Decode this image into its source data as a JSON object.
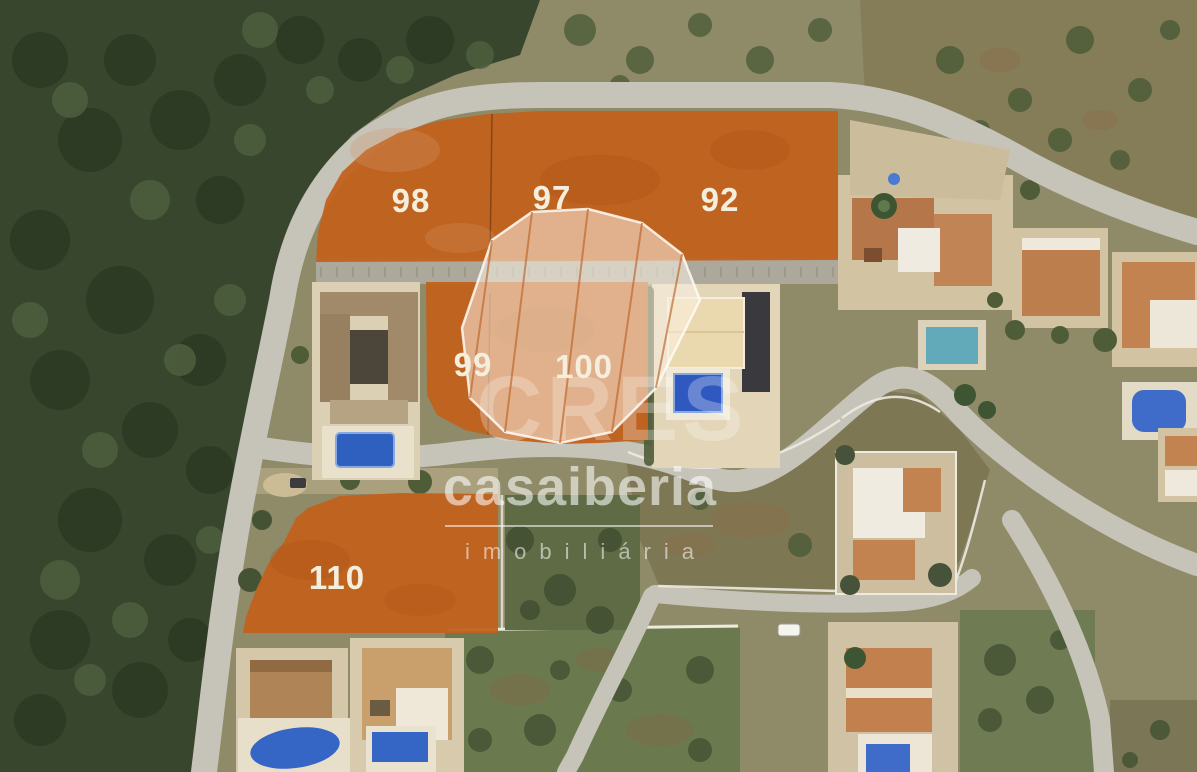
{
  "plots": {
    "items": [
      {
        "label": "98"
      },
      {
        "label": "97"
      },
      {
        "label": "92"
      },
      {
        "label": "99"
      },
      {
        "label": "100"
      },
      {
        "label": "110"
      }
    ],
    "overlay_color": "#C2611E",
    "label_color": "#F6EEDC"
  },
  "watermark": {
    "ghost_text": "CRES",
    "brand": "casaiberia",
    "tagline": "imobiliária"
  },
  "colors": {
    "pool_blue": "#3E6CC8",
    "road_gray": "#C6C3B9",
    "forest_green": "#38462E",
    "scrub_olive": "#8F8A68"
  }
}
